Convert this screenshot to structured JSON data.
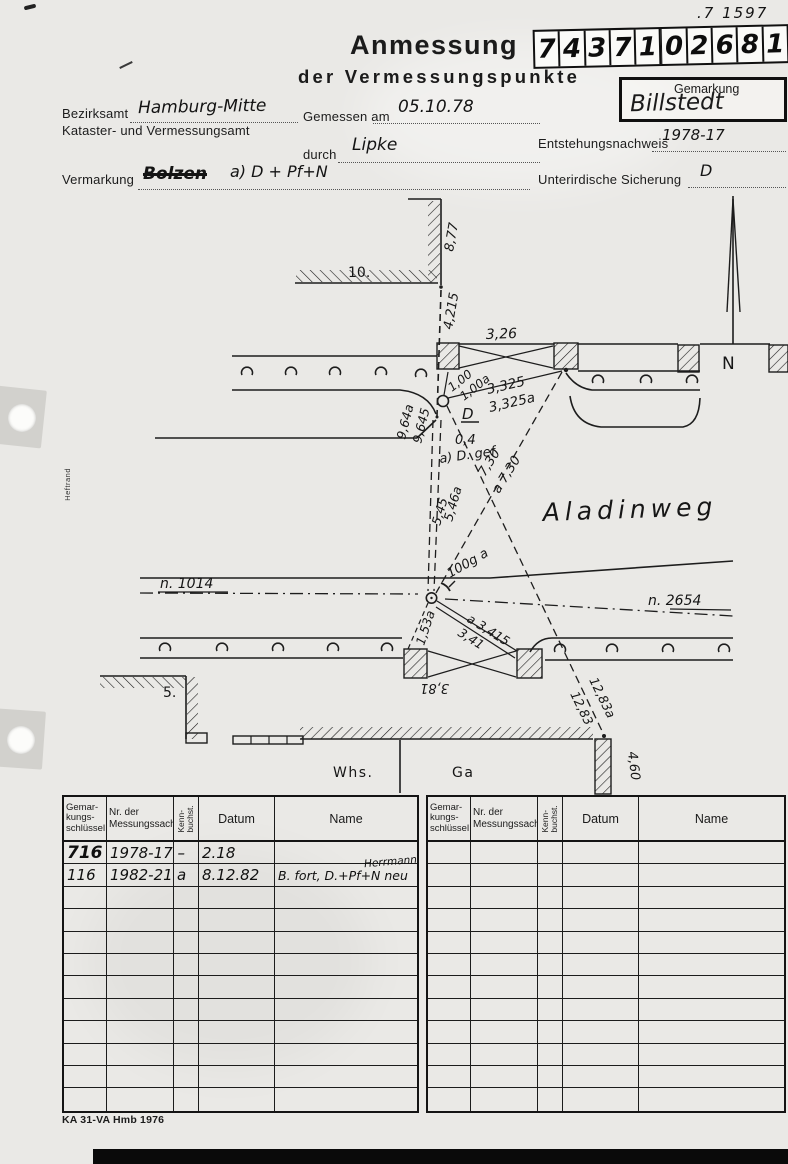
{
  "page": {
    "corner_note": ".7 1597",
    "footer": "KA 31-VA Hmb 1976",
    "margin_label": "Heftrand"
  },
  "header": {
    "title_line1": "Anmessung",
    "title_line2": "der Vermessungspunkte",
    "number_digits": [
      "7",
      "4",
      "3",
      "7",
      "1",
      "0",
      "2",
      "6",
      "8",
      "1"
    ],
    "gemarkung_label": "Gemarkung",
    "gemarkung_value": "Billstedt"
  },
  "form": {
    "bezirksamt_label": "Bezirksamt",
    "bezirksamt_value": "Hamburg-Mitte",
    "amt_line2": "Kataster- und Vermessungsamt",
    "gemessen_label": "Gemessen am",
    "gemessen_value": "05.10.78",
    "durch_label": "durch",
    "durch_value": "Lipke",
    "entstehung_label": "Entstehungsnachweis",
    "entstehung_value": "1978-17",
    "vermarkung_label": "Vermarkung",
    "vermarkung_struck": "Bolzen",
    "vermarkung_value": "a) D + Pf+N",
    "sicherung_label": "Unterirdische Sicherung",
    "sicherung_value": "D"
  },
  "sketch": {
    "street_name": "Aladinweg",
    "north": "N",
    "house_10": "10.",
    "house_5": "5.",
    "whs": "Whs.",
    "ga": "Ga",
    "line_left": "n. 1014",
    "line_right": "n. 2654",
    "d_877": "8,77",
    "d_4215": "4,215",
    "d_326": "3,26",
    "d_100": "1,00",
    "d_100a": "1,00a",
    "d_3325": "3,325",
    "d_3325a": "3,325a",
    "d_D": "D",
    "d_04": "0,4",
    "d_aDgef": "a) D. gef",
    "d_964a": "9,64a",
    "d_9645": "9,645",
    "d_546a": "5,46a",
    "d_545": "5,45",
    "d_730": "7,30",
    "d_730a": "a 7,30",
    "d_100g": "100g a",
    "d_3415a": "a 3,415",
    "d_341": "3,41",
    "d_153a": "1,53a",
    "d_381": "3,81",
    "d_1283a": "12,83a",
    "d_1283": "12,83",
    "d_460": "4,60"
  },
  "table": {
    "headers": {
      "col1a": "Gemar-",
      "col1b": "kungs-",
      "col1c": "schlüssel",
      "col2a": "Nr. der",
      "col2b": "Messungssache",
      "col3a": "Kenn-",
      "col3b": "buchst.",
      "col4": "Datum",
      "col5": "Name"
    },
    "rows": [
      {
        "schluessel": "716",
        "sache": "1978-17 –",
        "kenn": "",
        "datum": "2.18",
        "name": "",
        "name_note": ""
      },
      {
        "schluessel": "116",
        "sache": "1982-21",
        "kenn": "a",
        "datum": "8.12.82",
        "name": "B. fort, D.+Pf+N neu",
        "name_note": "Herrmann"
      }
    ]
  }
}
